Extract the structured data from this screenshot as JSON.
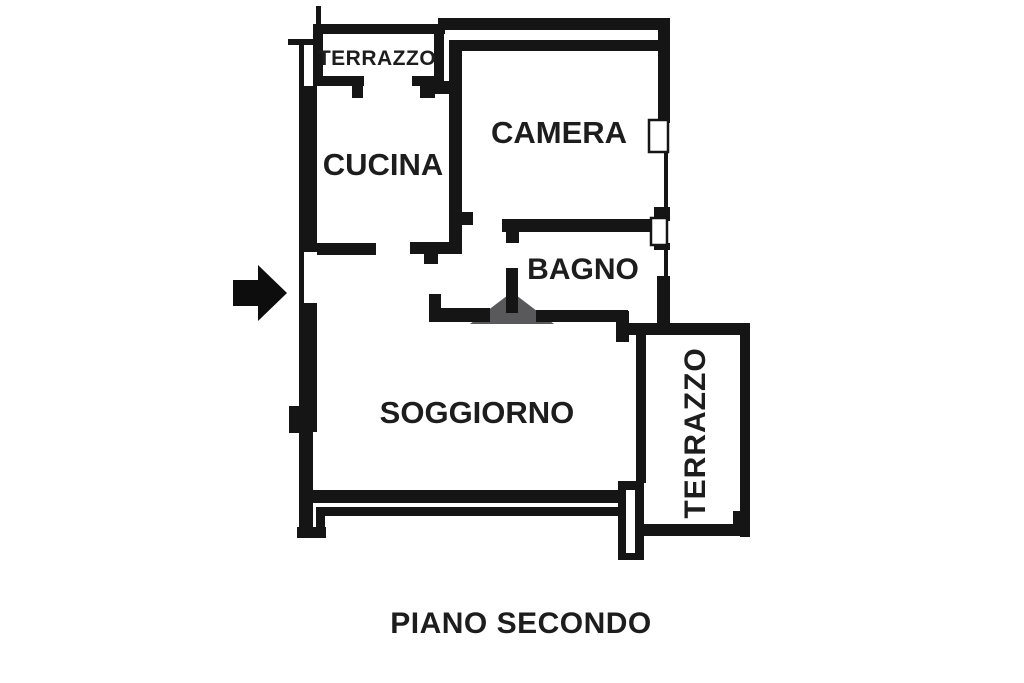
{
  "meta": {
    "caption": "PIANO SECONDO",
    "type_hint": "apartment floor plan"
  },
  "colors": {
    "background": "#ffffff",
    "wall": "#151515",
    "label": "#1d1d1d",
    "door_swing": "#59595b",
    "entrance_arrow": "#0d0d0d"
  },
  "rooms": {
    "terrazzo_top": {
      "label": "TERRAZZO"
    },
    "cucina": {
      "label": "CUCINA"
    },
    "camera": {
      "label": "CAMERA"
    },
    "bagno": {
      "label": "BAGNO"
    },
    "soggiorno": {
      "label": "SOGGIORNO"
    },
    "terrazzo_right": {
      "label": "TERRAZZO"
    }
  },
  "symbols": {
    "entrance_arrow": "right-pointing entrance arrow",
    "door_swing": "door swing triangle"
  }
}
